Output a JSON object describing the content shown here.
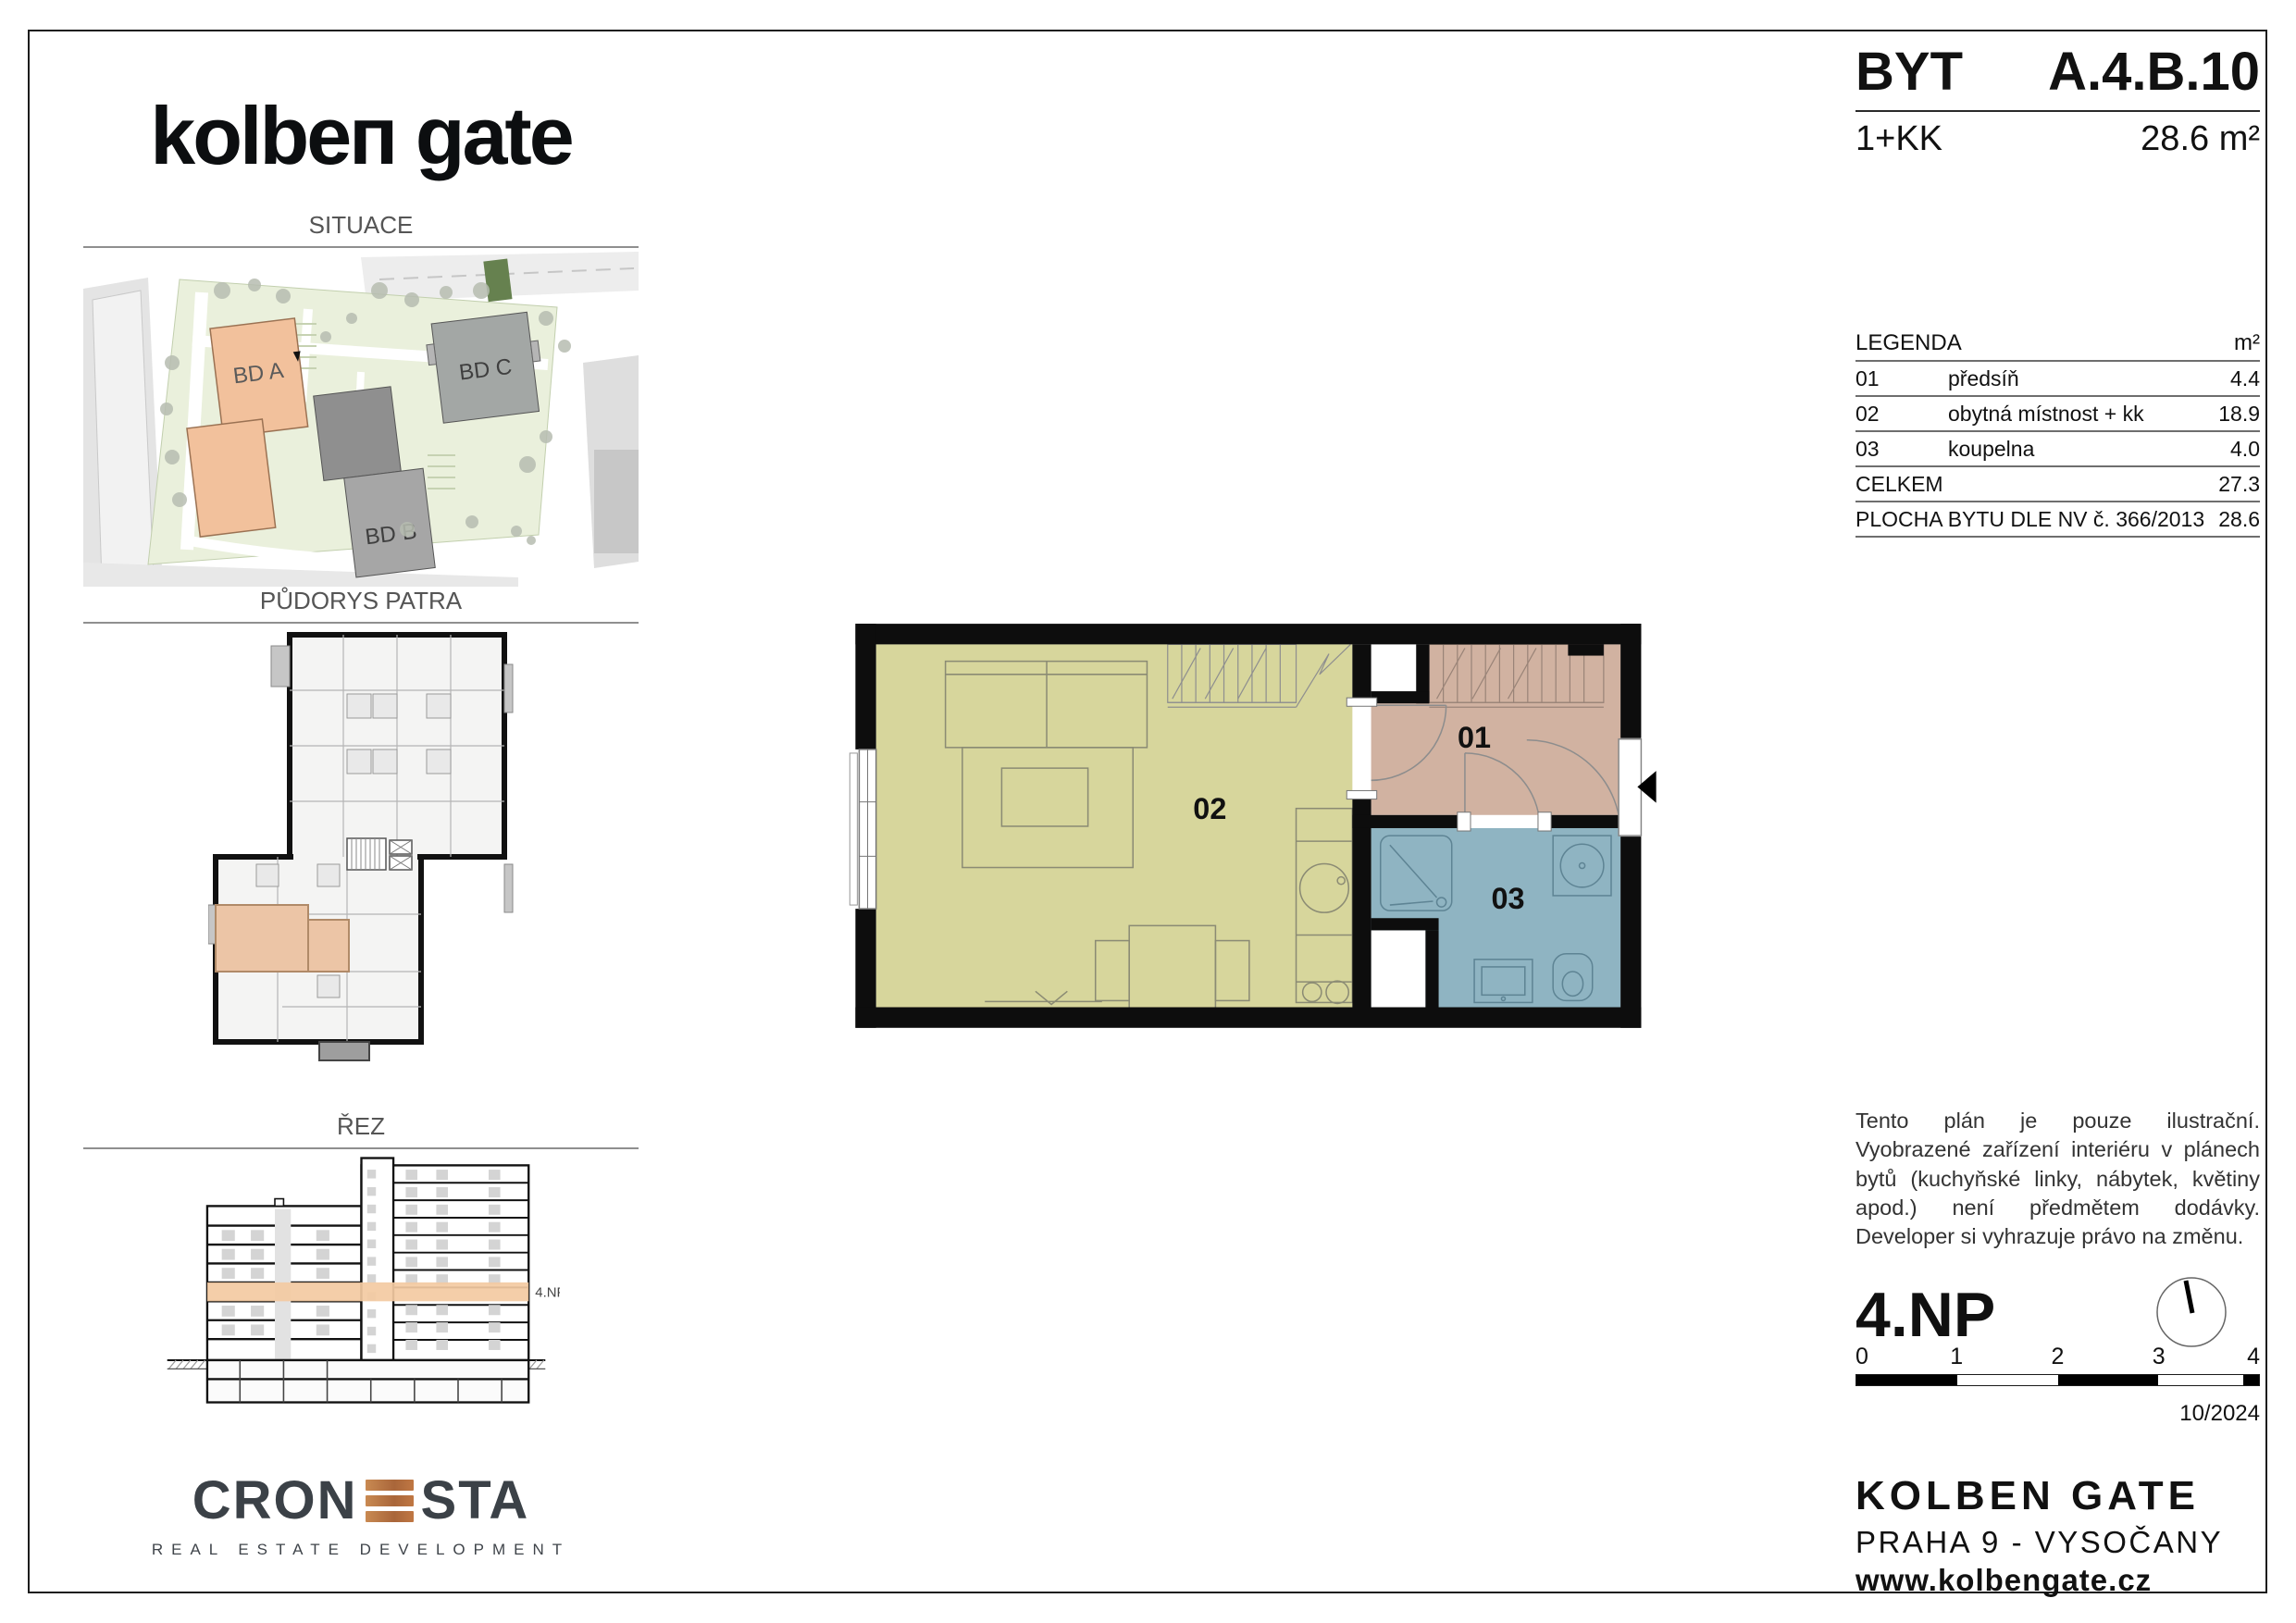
{
  "logo": {
    "wordmark": "kolbeп gate"
  },
  "title_block": {
    "type_label": "BYT",
    "unit_code": "A.4.B.10",
    "disposition": "1+KK",
    "area": "28.6 m²"
  },
  "section_headers": {
    "situace": "SITUACE",
    "pudorys": "PŮDORYS PATRA",
    "rez": "ŘEZ"
  },
  "site_plan": {
    "building_a": "BD A",
    "building_b": "BD B",
    "building_c": "BD C"
  },
  "unit_plan": {
    "room_01": "01",
    "room_02": "02",
    "room_03": "03"
  },
  "section_view": {
    "floor_band_label": "4.NP"
  },
  "legend": {
    "title": "LEGENDA",
    "area_unit": "m²",
    "rows": [
      {
        "code": "01",
        "name": "předsíň",
        "area": "4.4"
      },
      {
        "code": "02",
        "name": "obytná místnost + kk",
        "area": "18.9"
      },
      {
        "code": "03",
        "name": "koupelna",
        "area": "4.0"
      }
    ],
    "total_label": "CELKEM",
    "total_area": "27.3",
    "statutory_label": "PLOCHA BYTU DLE NV č. 366/2013",
    "statutory_area": "28.6"
  },
  "disclaimer": "Tento plán je pouze ilustrační. Vyobrazené zařízení interiéru v plánech bytů (kuchyňské linky, nábytek, květiny apod.) není předmětem dodávky. Developer si vyhrazuje právo na změnu.",
  "floor_info": {
    "floor": "4.NP",
    "scale_ticks": [
      "0",
      "1",
      "2",
      "3",
      "4"
    ],
    "issue_date": "10/2024"
  },
  "project_footer": {
    "name": "KOLBEN GATE",
    "location": "PRAHA 9 - VYSOČANY",
    "website": "www.kolbengate.cz"
  },
  "developer": {
    "brand_left": "CRON",
    "brand_right": "STA",
    "tagline": "REAL ESTATE DEVELOPMENT"
  },
  "colors": {
    "room_living": "#d7d69c",
    "room_hall": "#d1b2a1",
    "room_bath": "#8fb4c2",
    "highlight_unit": "#ecc5a6",
    "floor_band": "#f3caa2",
    "brand_copper": "#bb7544"
  }
}
